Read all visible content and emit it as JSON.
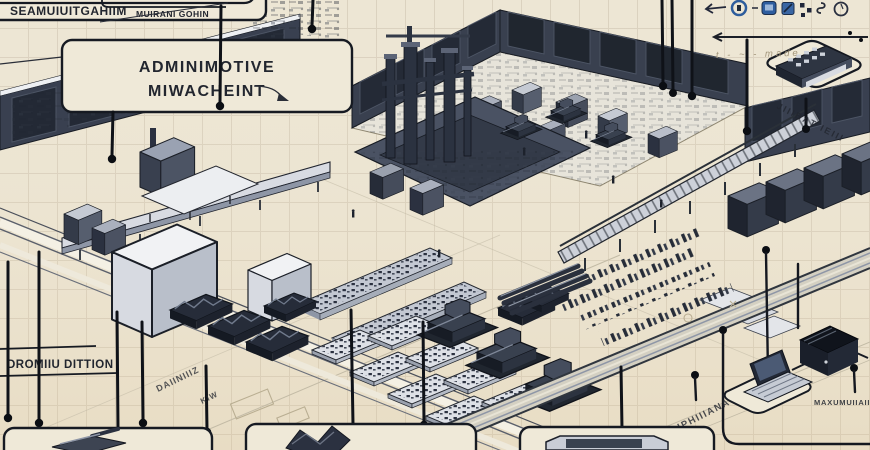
{
  "figure": {
    "type": "isometric-factory-blueprint-illustration",
    "description": "hand-drawn style isometric factory floor plan with callout labels"
  },
  "palette": {
    "background": "#EDE6D4",
    "ink": "#14171F",
    "machine_dark": "#2B3140",
    "machine_mid": "#8E96A6",
    "machine_light": "#E2E4EA",
    "accent_blue": "#2F5F9E",
    "pencil": "#A2957A"
  },
  "labels": {
    "top_left_partial": "SEAMUIUITGAHIIM",
    "top_mid_partial": "MUIRANI GOHIN",
    "admin_line1": "ADMINIMOTIVE",
    "admin_line2": "MIWACHEINT",
    "production": "DROMIIU DITTION",
    "right_panel_caption": "JIIIBAT IEIII",
    "road_text_a": "DAIINIIIZ",
    "road_text_b": "KIW",
    "machine_text": "AIPHIIIANA",
    "bottom_right_caption": "MAXUMUIIAIIII",
    "legend_caption": "t - ~ - made"
  },
  "legend": {
    "icons": [
      "arrow-left-icon",
      "gauge-icon",
      "panel-icon",
      "chip-icon",
      "dots-icon",
      "hook-icon",
      "dial-icon"
    ]
  }
}
